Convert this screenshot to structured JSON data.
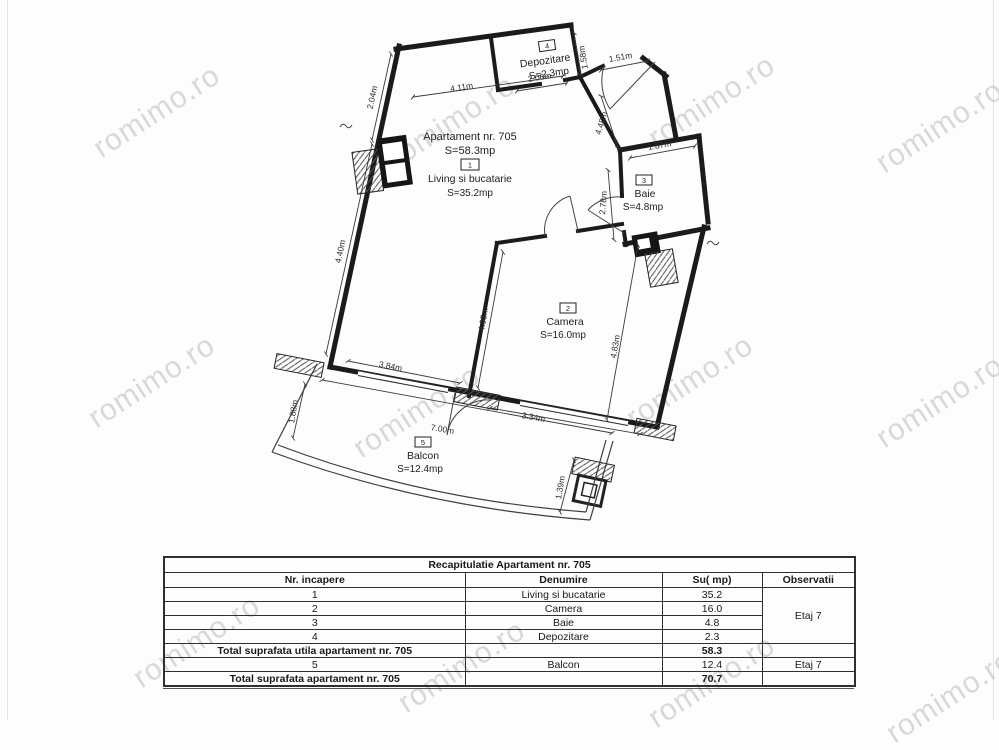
{
  "watermark": {
    "text": "romimo.ro"
  },
  "plan": {
    "apartment": {
      "title": "Apartament nr. 705",
      "area": "S=58.3mp"
    },
    "rooms": [
      {
        "num": "1",
        "name": "Living si bucatarie",
        "area": "S=35.2mp"
      },
      {
        "num": "2",
        "name": "Camera",
        "area": "S=16.0mp"
      },
      {
        "num": "3",
        "name": "Baie",
        "area": "S=4.8mp"
      },
      {
        "num": "4",
        "name": "Depozitare",
        "area": "S=2.3mp"
      },
      {
        "num": "5",
        "name": "Balcon",
        "area": "S=12.4mp"
      }
    ],
    "dims": {
      "top_living": "4.11m",
      "depozitare_w": "2.06m",
      "entry_w": "1.51m",
      "depozitare_d": "1.58m",
      "left_top": "2.04m",
      "left_bottom": "4.40m",
      "hall_h": "4.48m",
      "baie_w": "1.87m",
      "baie_h": "2.78m",
      "divider_h": "4.95m",
      "camera_h": "4.83m",
      "bottom_left": "3.84m",
      "camera_w": "3.34m",
      "balcony_w": "7.00m",
      "balcony_left": "1.88m",
      "balcony_right": "1.39m"
    }
  },
  "table": {
    "title": "Recapitulatie Apartament nr. 705",
    "headers": [
      "Nr. incapere",
      "Denumire",
      "Su( mp)",
      "Observatii"
    ],
    "rows": [
      {
        "nr": "1",
        "denumire": "Living si bucatarie",
        "su": "35.2"
      },
      {
        "nr": "2",
        "denumire": "Camera",
        "su": "16.0"
      },
      {
        "nr": "3",
        "denumire": "Baie",
        "su": "4.8"
      },
      {
        "nr": "4",
        "denumire": "Depozitare",
        "su": "2.3"
      }
    ],
    "rows_observatii": "Etaj 7",
    "total_utila": {
      "label": "Total suprafata utila apartament nr. 705",
      "su": "58.3"
    },
    "balcon_row": {
      "nr": "5",
      "denumire": "Balcon",
      "su": "12.4",
      "observatii": "Etaj 7"
    },
    "total": {
      "label": "Total suprafata apartament nr. 705",
      "su": "70.7"
    }
  }
}
